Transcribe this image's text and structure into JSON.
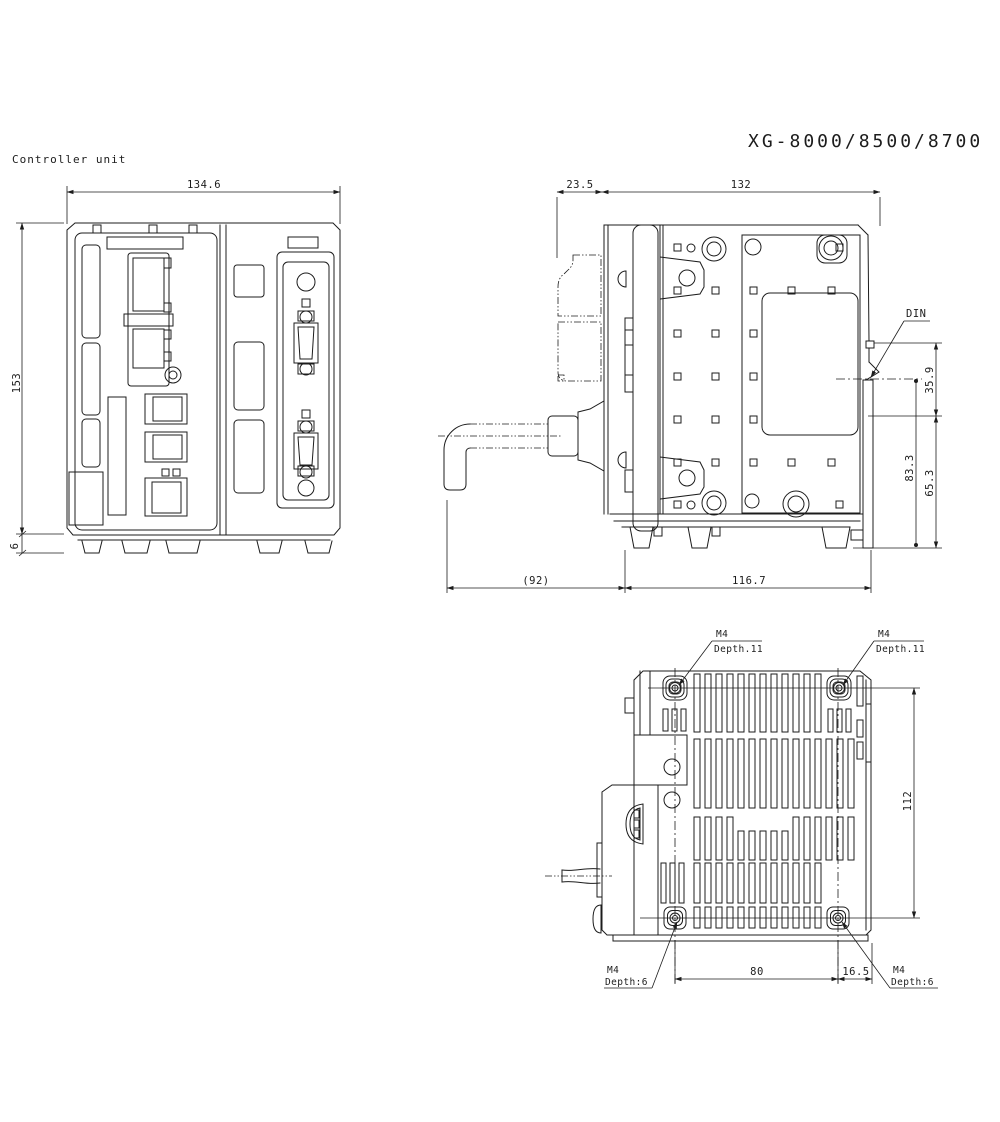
{
  "drawing": {
    "product_label": "Controller unit",
    "title": "XG-8000/8500/8700",
    "ink_color": "#1c1c1c",
    "paper_color": "#ffffff"
  },
  "front_view": {
    "dim_width": "134.6",
    "dim_height": "153",
    "dim_foot": "6"
  },
  "side_view": {
    "dim_front_depth": "23.5",
    "dim_body_depth": "132",
    "din_label": "DIN",
    "dim_din_to_top": "35.9",
    "dim_din_to_bottom": "83.3",
    "dim_lower_section": "65.3",
    "dim_cable": "(92)",
    "dim_mount_depth": "116.7"
  },
  "bottom_view": {
    "screw_top_left": {
      "thread": "M4",
      "depth": "Depth.11"
    },
    "screw_top_right": {
      "thread": "M4",
      "depth": "Depth.11"
    },
    "screw_bottom_left": {
      "thread": "M4",
      "depth": "Depth:6"
    },
    "screw_bottom_right": {
      "thread": "M4",
      "depth": "Depth:6"
    },
    "dim_screw_vertical_pitch": "112",
    "dim_screw_horizontal_pitch": "80",
    "dim_screw_to_edge": "16.5"
  }
}
